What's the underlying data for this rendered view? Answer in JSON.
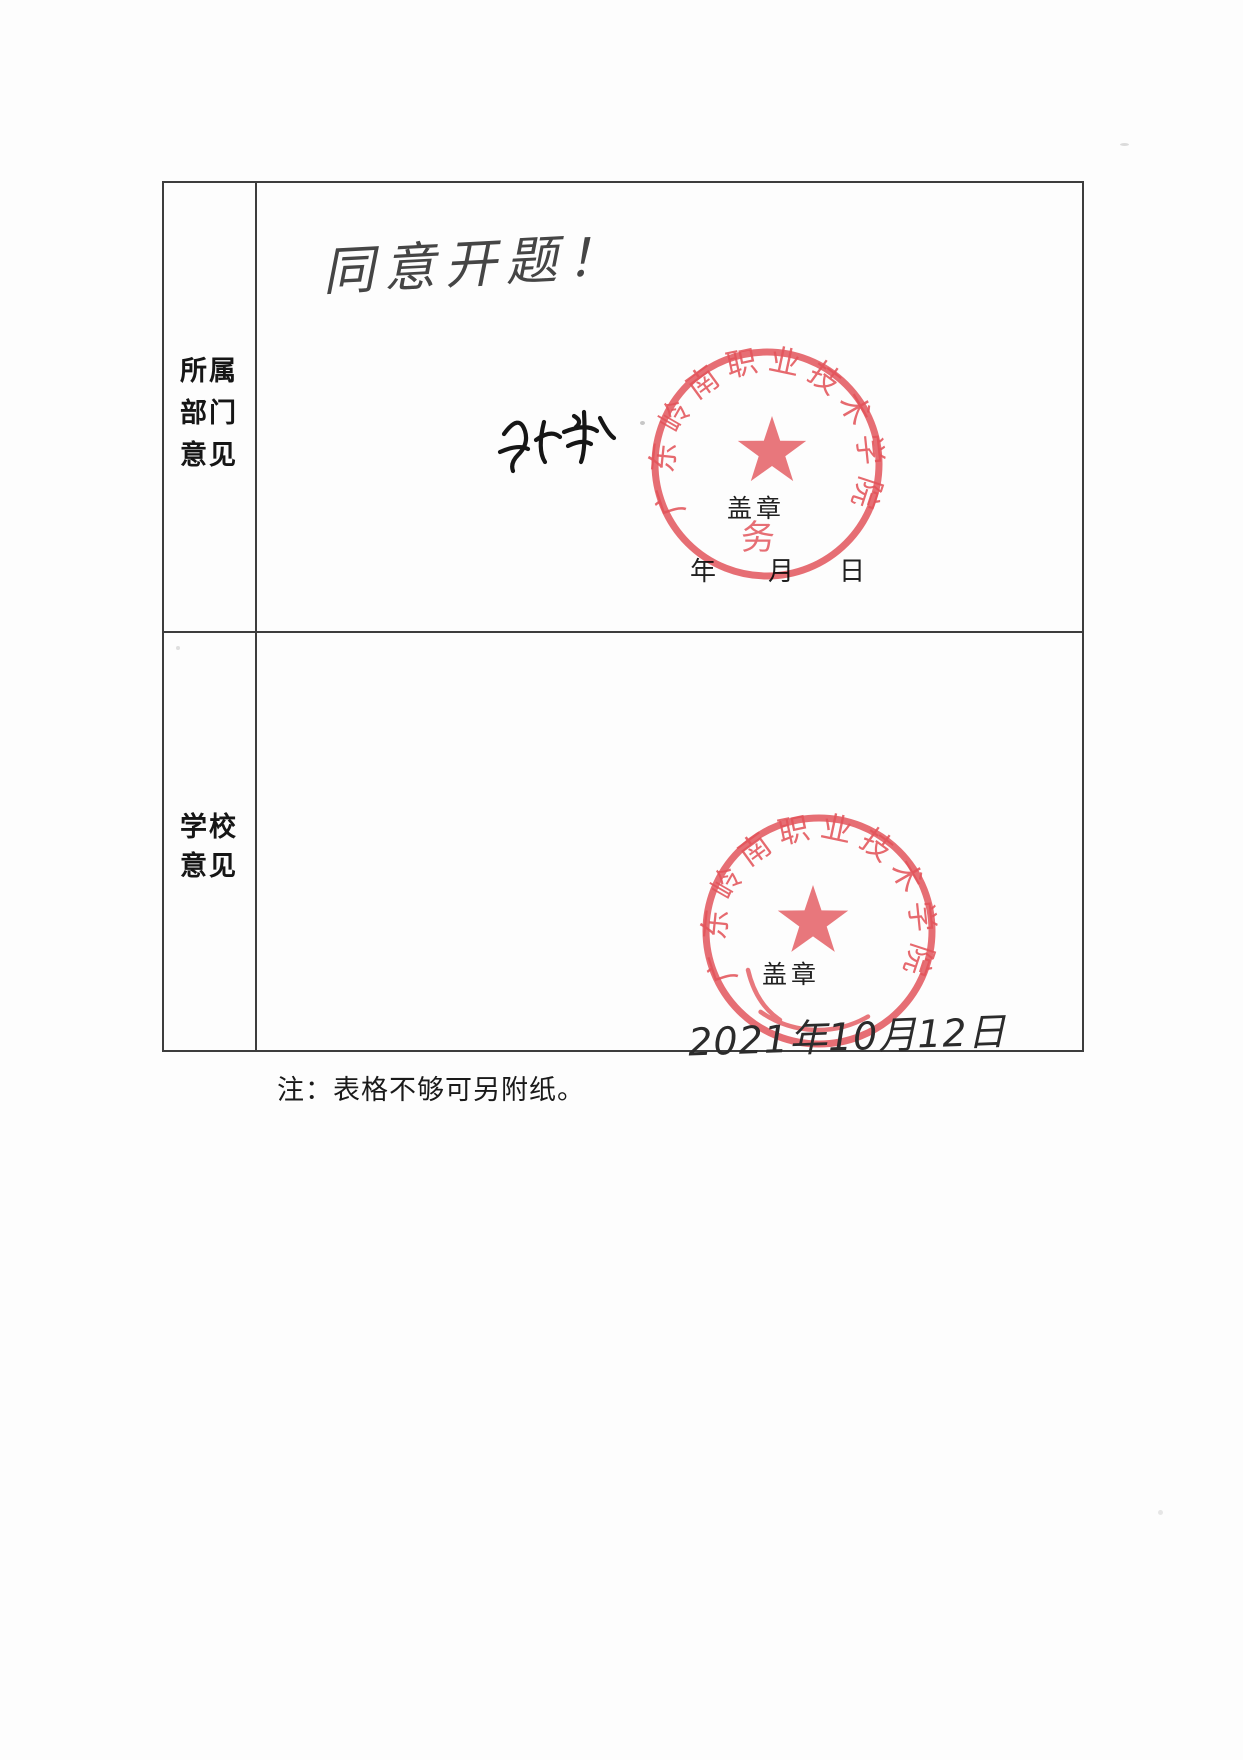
{
  "row1": {
    "label_lines": [
      "所属",
      "部门",
      "意见"
    ],
    "handwritten_comment": "同意开题！",
    "stamp_here_label": "盖章",
    "year_label": "年",
    "month_label": "月",
    "day_label": "日",
    "seal": {
      "ring_text": "广东岭南职业技术学院",
      "department_text": "教务处",
      "ink_color": "#e2484f"
    }
  },
  "row2": {
    "label_lines": [
      "学校",
      "意见"
    ],
    "stamp_here_label": "盖章",
    "handwritten_date": "2021年10月12日",
    "seal": {
      "ring_text": "广东岭南职业技术学院",
      "ink_color": "#e2484f"
    }
  },
  "footnote": "注：表格不够可另附纸。"
}
